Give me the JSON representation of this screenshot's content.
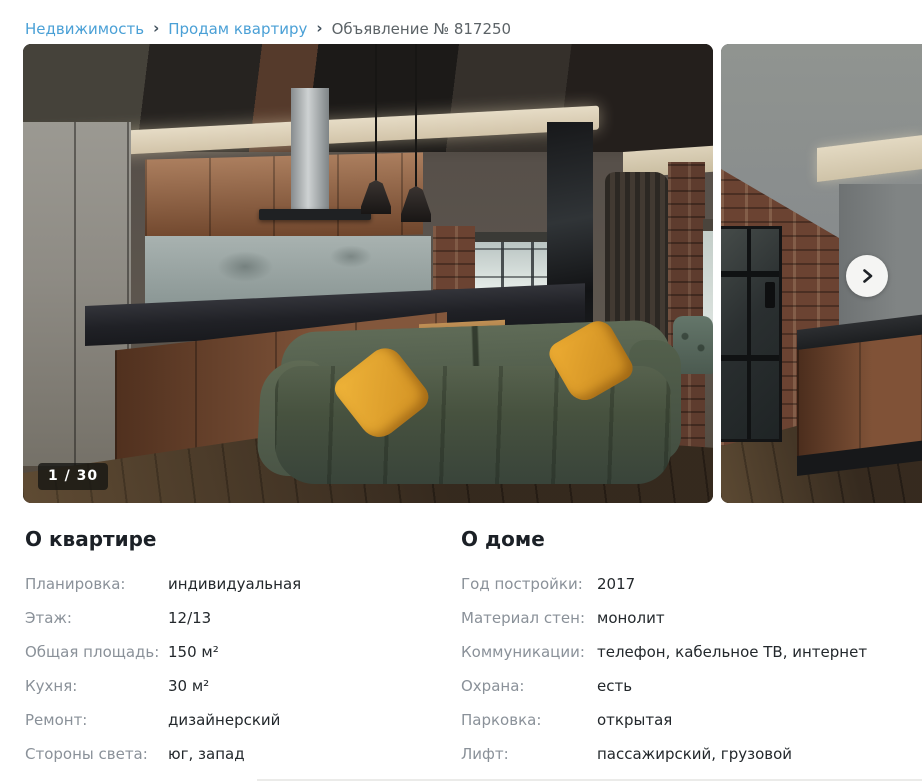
{
  "breadcrumb": {
    "separator": "›",
    "items": [
      {
        "label": "Недвижимость"
      },
      {
        "label": "Продам квартиру"
      },
      {
        "label": "Объявление № 817250"
      }
    ]
  },
  "gallery": {
    "counter": "1 / 30"
  },
  "about_apartment": {
    "title": "О квартире",
    "rows": [
      {
        "label": "Планировка:",
        "value": "индивидуальная"
      },
      {
        "label": "Этаж:",
        "value": "12/13"
      },
      {
        "label": "Общая площадь:",
        "value": "150 м²"
      },
      {
        "label": "Кухня:",
        "value": "30 м²"
      },
      {
        "label": "Ремонт:",
        "value": "дизайнерский"
      },
      {
        "label": "Стороны света:",
        "value": "юг, запад"
      }
    ]
  },
  "about_house": {
    "title": "О доме",
    "rows": [
      {
        "label": "Год постройки:",
        "value": "2017"
      },
      {
        "label": "Материал стен:",
        "value": "монолит"
      },
      {
        "label": "Коммуникации:",
        "value": "телефон, кабельное ТВ, интернет"
      },
      {
        "label": "Охрана:",
        "value": "есть"
      },
      {
        "label": "Парковка:",
        "value": "открытая"
      },
      {
        "label": "Лифт:",
        "value": "пассажирский, грузовой"
      }
    ]
  },
  "colors": {
    "link_blue": "#4aa0d6",
    "breadcrumb_current": "#5c6367",
    "label_gray": "#8a9199",
    "value_dark": "#23282c",
    "badge_bg": "rgba(22,22,19,0.8)",
    "pillow_yellow": "#e0a22c",
    "sofa_green": "#4d5948"
  }
}
